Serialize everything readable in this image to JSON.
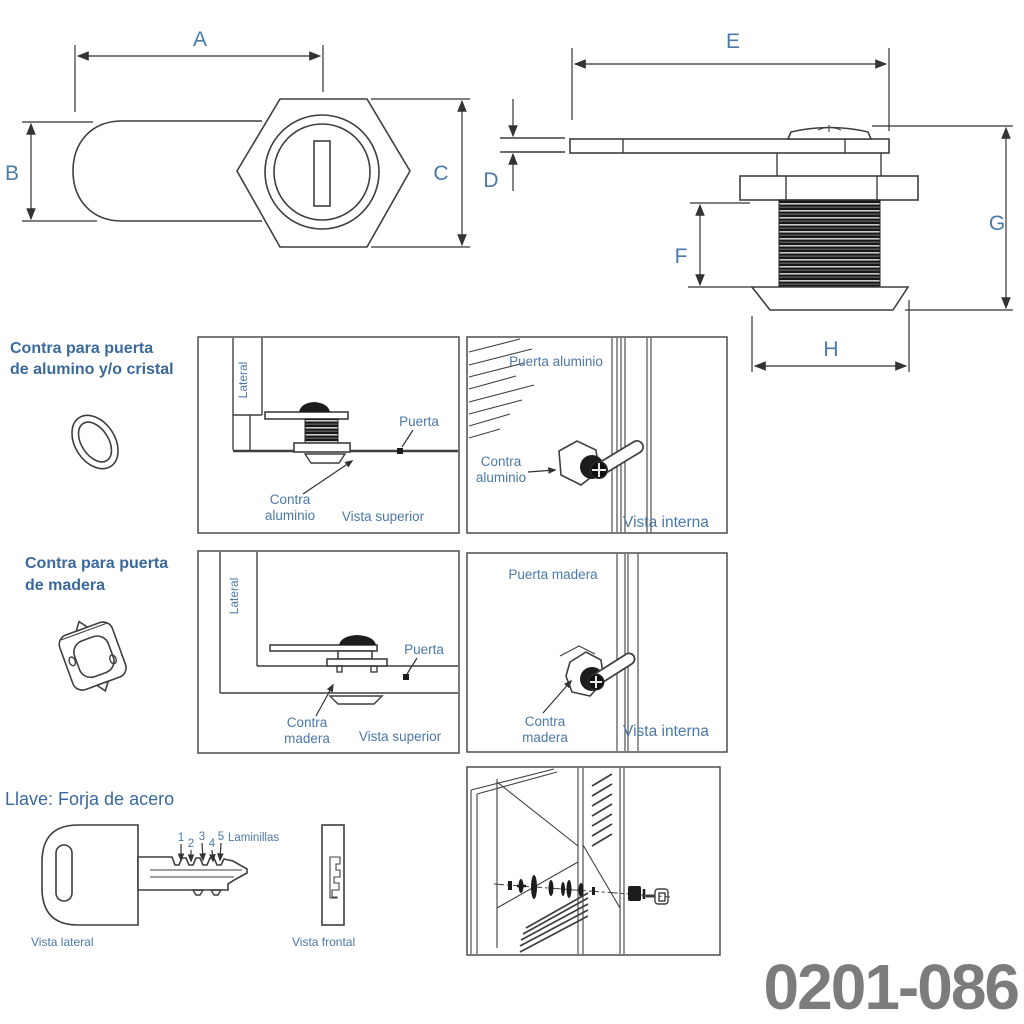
{
  "part_number": "0201-086",
  "colors": {
    "label_blue": "#4b79a8",
    "header_blue": "#3a699c",
    "line_dark": "#3f3f3f",
    "part_number_gray": "#7c7c7c"
  },
  "dims": {
    "A": "A",
    "B": "B",
    "C": "C",
    "D": "D",
    "E": "E",
    "F": "F",
    "G": "G",
    "H": "H"
  },
  "sections": {
    "aluminio": {
      "title1": "Contra para puerta",
      "title2": "de alumino y/o cristal",
      "top_view": {
        "lateral": "Lateral",
        "puerta": "Puerta",
        "contra1": "Contra",
        "contra2": "aluminio",
        "caption": "Vista superior"
      },
      "internal_view": {
        "door": "Puerta aluminio",
        "contra1": "Contra",
        "contra2": "aluminio",
        "caption": "Vista interna"
      }
    },
    "madera": {
      "title1": "Contra para puerta",
      "title2": "de madera",
      "top_view": {
        "lateral": "Lateral",
        "puerta": "Puerta",
        "contra1": "Contra",
        "contra2": "madera",
        "caption": "Vista superior"
      },
      "internal_view": {
        "door": "Puerta madera",
        "contra1": "Contra",
        "contra2": "madera",
        "caption": "Vista interna"
      }
    },
    "llave": {
      "title": "Llave: Forja de acero",
      "numbers": [
        "1",
        "2",
        "3",
        "4",
        "5"
      ],
      "laminillas": "Laminillas",
      "side_caption": "Vista lateral",
      "front_caption": "Vista frontal"
    }
  }
}
